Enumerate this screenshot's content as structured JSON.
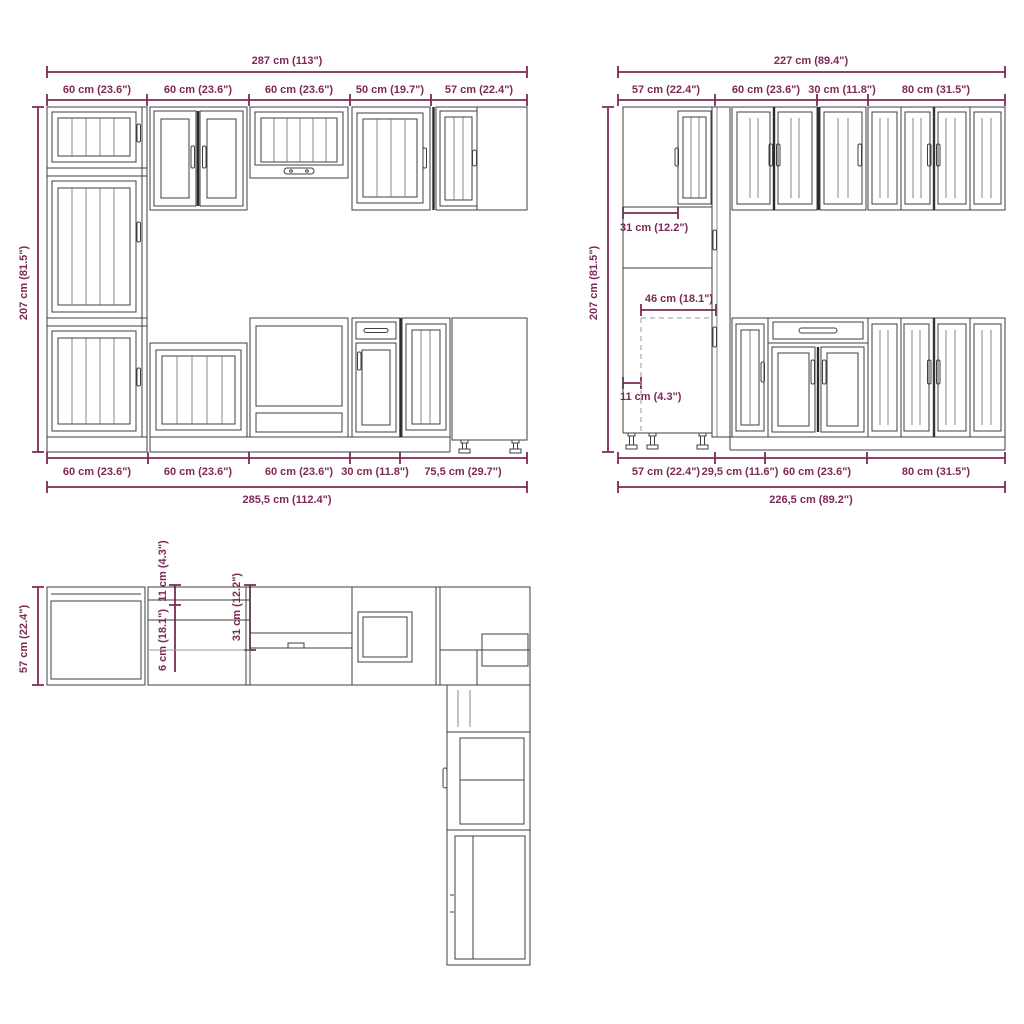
{
  "title": "Kitchen cabinet set dimension diagram",
  "colors": {
    "dimension": "#7d2a55",
    "line_art": "#3f3f3f",
    "background": "#ffffff"
  },
  "front_left": {
    "total_width": "287 cm (113\")",
    "height": "207 cm (81.5\")",
    "top_segments": [
      "60 cm (23.6\")",
      "60 cm (23.6\")",
      "60 cm (23.6\")",
      "50 cm (19.7\")",
      "57 cm (22.4\")"
    ],
    "bottom_segments": [
      "60 cm (23.6\")",
      "60 cm (23.6\")",
      "60 cm (23.6\")",
      "30 cm (11.8\")",
      "75,5 cm (29.7\")"
    ],
    "total_width_bottom": "285,5 cm (112.4\")"
  },
  "front_right": {
    "total_width": "227 cm (89.4\")",
    "height": "207 cm (81.5\")",
    "top_segments": [
      "57 cm (22.4\")",
      "60 cm (23.6\")",
      "30 cm (11.8\")",
      "80 cm (31.5\")"
    ],
    "door_width": "31 cm (12.2\")",
    "niche_width": "46 cm (18.1\")",
    "side_depth": "11 cm (4.3\")",
    "bottom_segments": [
      "57 cm (22.4\")",
      "29,5 cm (11.6\")",
      "60 cm (23.6\")",
      "80 cm (31.5\")"
    ],
    "total_width_bottom": "226,5 cm (89.2\")"
  },
  "plan": {
    "depth": "57 cm (22.4\")",
    "dim_upper": "11 cm (4.3\")",
    "dim_lower": "6 cm (18.1\")",
    "dim_right": "31 cm (12.2\")"
  }
}
